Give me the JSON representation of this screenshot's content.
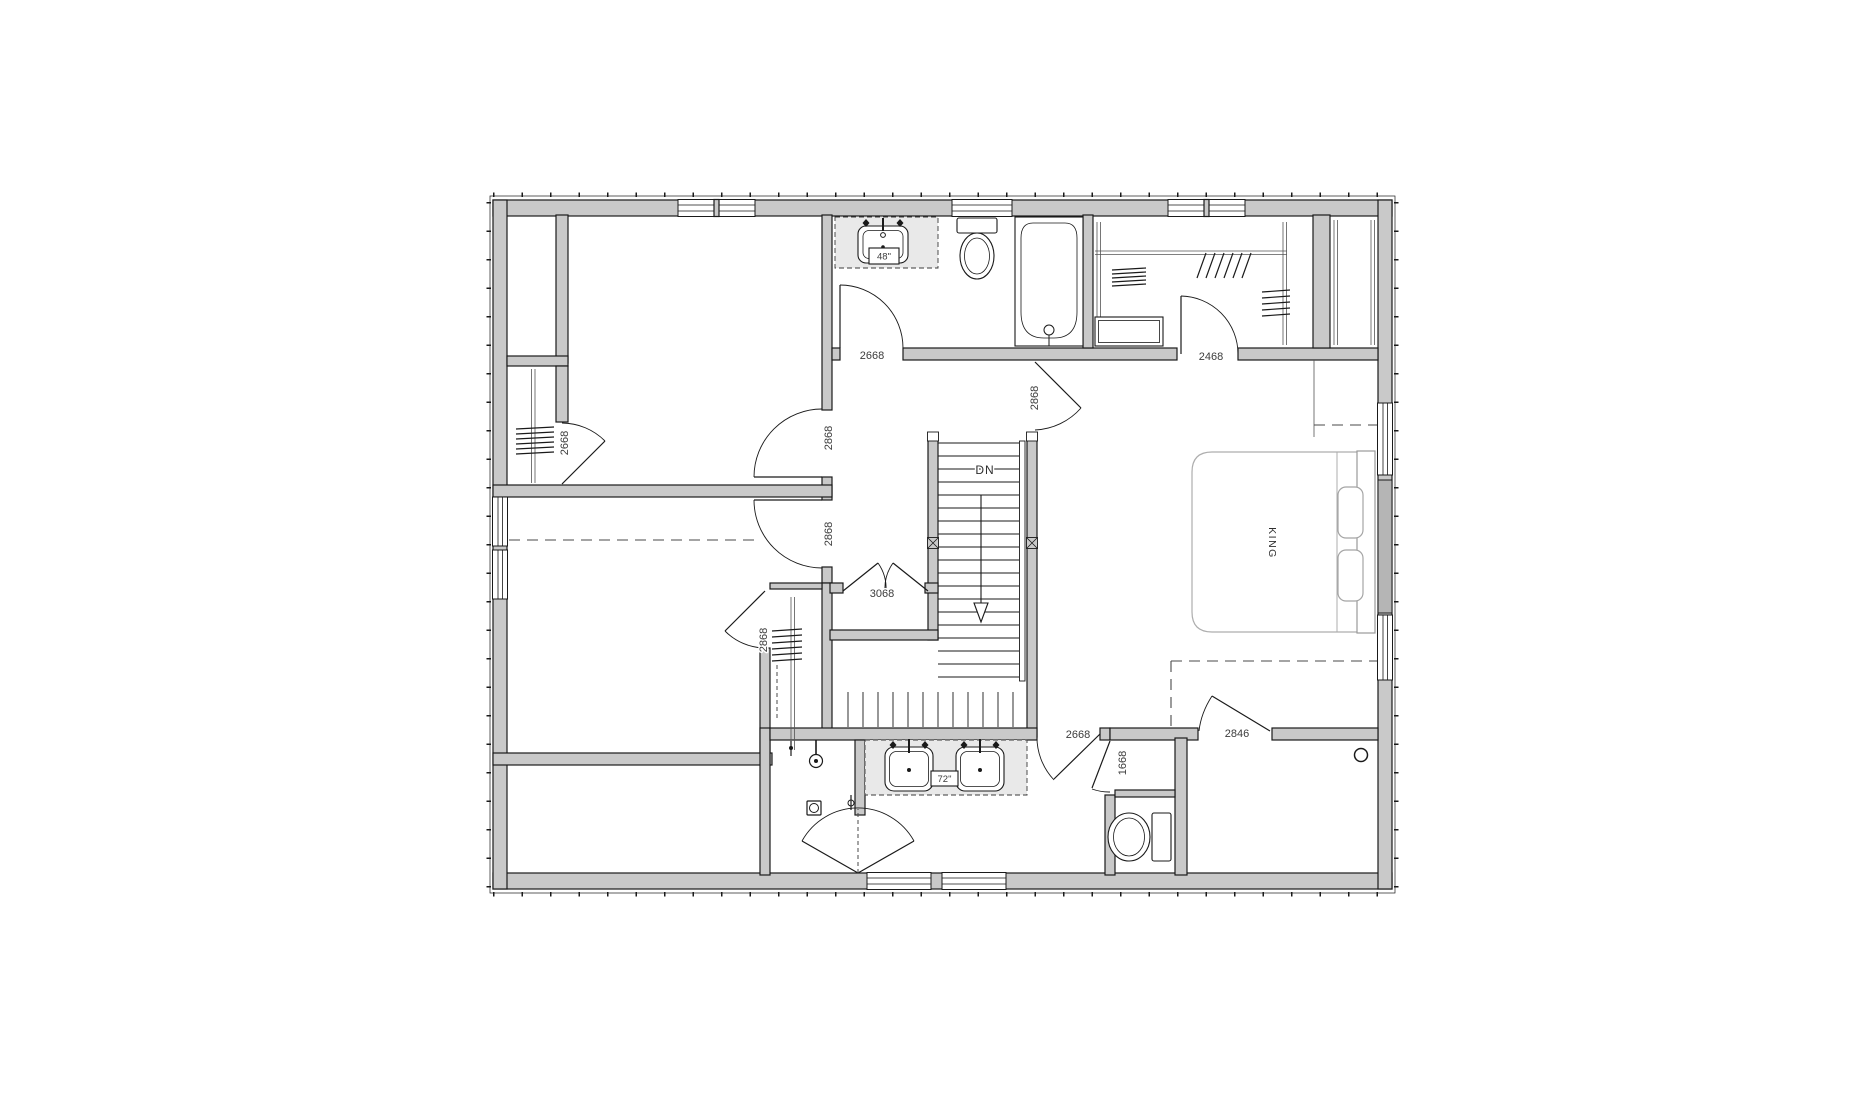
{
  "drawing": {
    "type": "architectural-floor-plan",
    "door_labels": {
      "bedroom2_closet": "2668",
      "bedroom2_entry": "2868",
      "bedroom3_entry": "2868",
      "bedroom3_closet": "2868",
      "hall_bathroom_entry": "2668",
      "hall_closet": "3068",
      "master_bedroom_entry": "2868",
      "walk_in_closet_entry": "2468",
      "master_bathroom_entry": "2668",
      "water_closet_entry": "1668",
      "master_closet_entry": "2846"
    },
    "fixture_labels": {
      "hall_bath_vanity_width": "48\"",
      "master_bath_vanity_width": "72\""
    },
    "annotations": {
      "stair_direction": "DN",
      "bed_size": "KING"
    },
    "colors": {
      "background": "#ffffff",
      "wall_fill": "#c9c9c9",
      "wall_line": "#1a1a1a",
      "counter_fill": "#e9e9e9",
      "furniture_line": "#adadad",
      "label_text": "#3c3c3c"
    }
  }
}
